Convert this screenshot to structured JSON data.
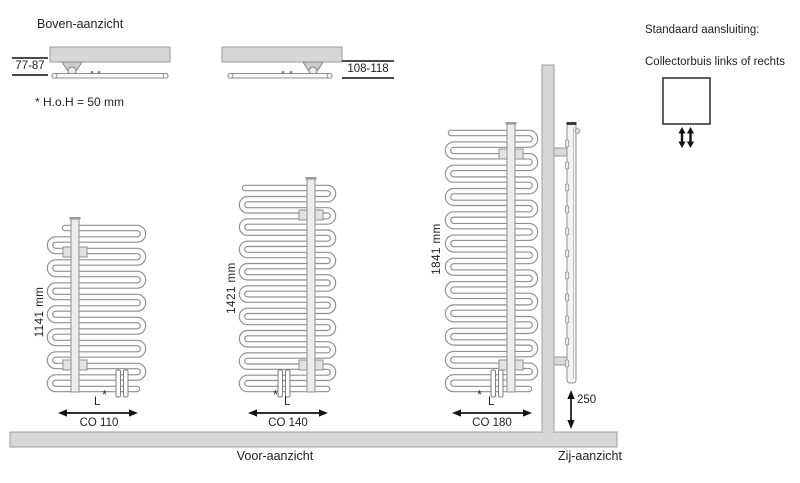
{
  "titles": {
    "top_view": "Boven-aanzicht",
    "front_view": "Voor-aanzicht",
    "side_view": "Zij-aanzicht"
  },
  "notes": {
    "hoh_note": "* H.o.H = 50 mm",
    "connection_title": "Standaard aansluiting:",
    "connection_subtitle": "Collectorbuis links of rechts",
    "footnote_symbol": "*"
  },
  "top_views": [
    {
      "wall_distance": "77-87"
    },
    {
      "wall_distance": "108-118"
    }
  ],
  "radiators": [
    {
      "model": "CO 110",
      "height_label": "1141 mm",
      "width_label": "L"
    },
    {
      "model": "CO 140",
      "height_label": "1421 mm",
      "width_label": "L"
    },
    {
      "model": "CO 180",
      "height_label": "1841 mm",
      "width_label": "L"
    }
  ],
  "side_view": {
    "floor_distance": "250"
  },
  "colors": {
    "wall_fill": "#d7d7d7",
    "wall_stroke": "#9c9c9c",
    "tube_stroke": "#8f8f8f",
    "tube_fill": "#fdfdfd",
    "collector_fill": "#ededed",
    "arrow_color": "#141414",
    "text_color": "#222222"
  }
}
